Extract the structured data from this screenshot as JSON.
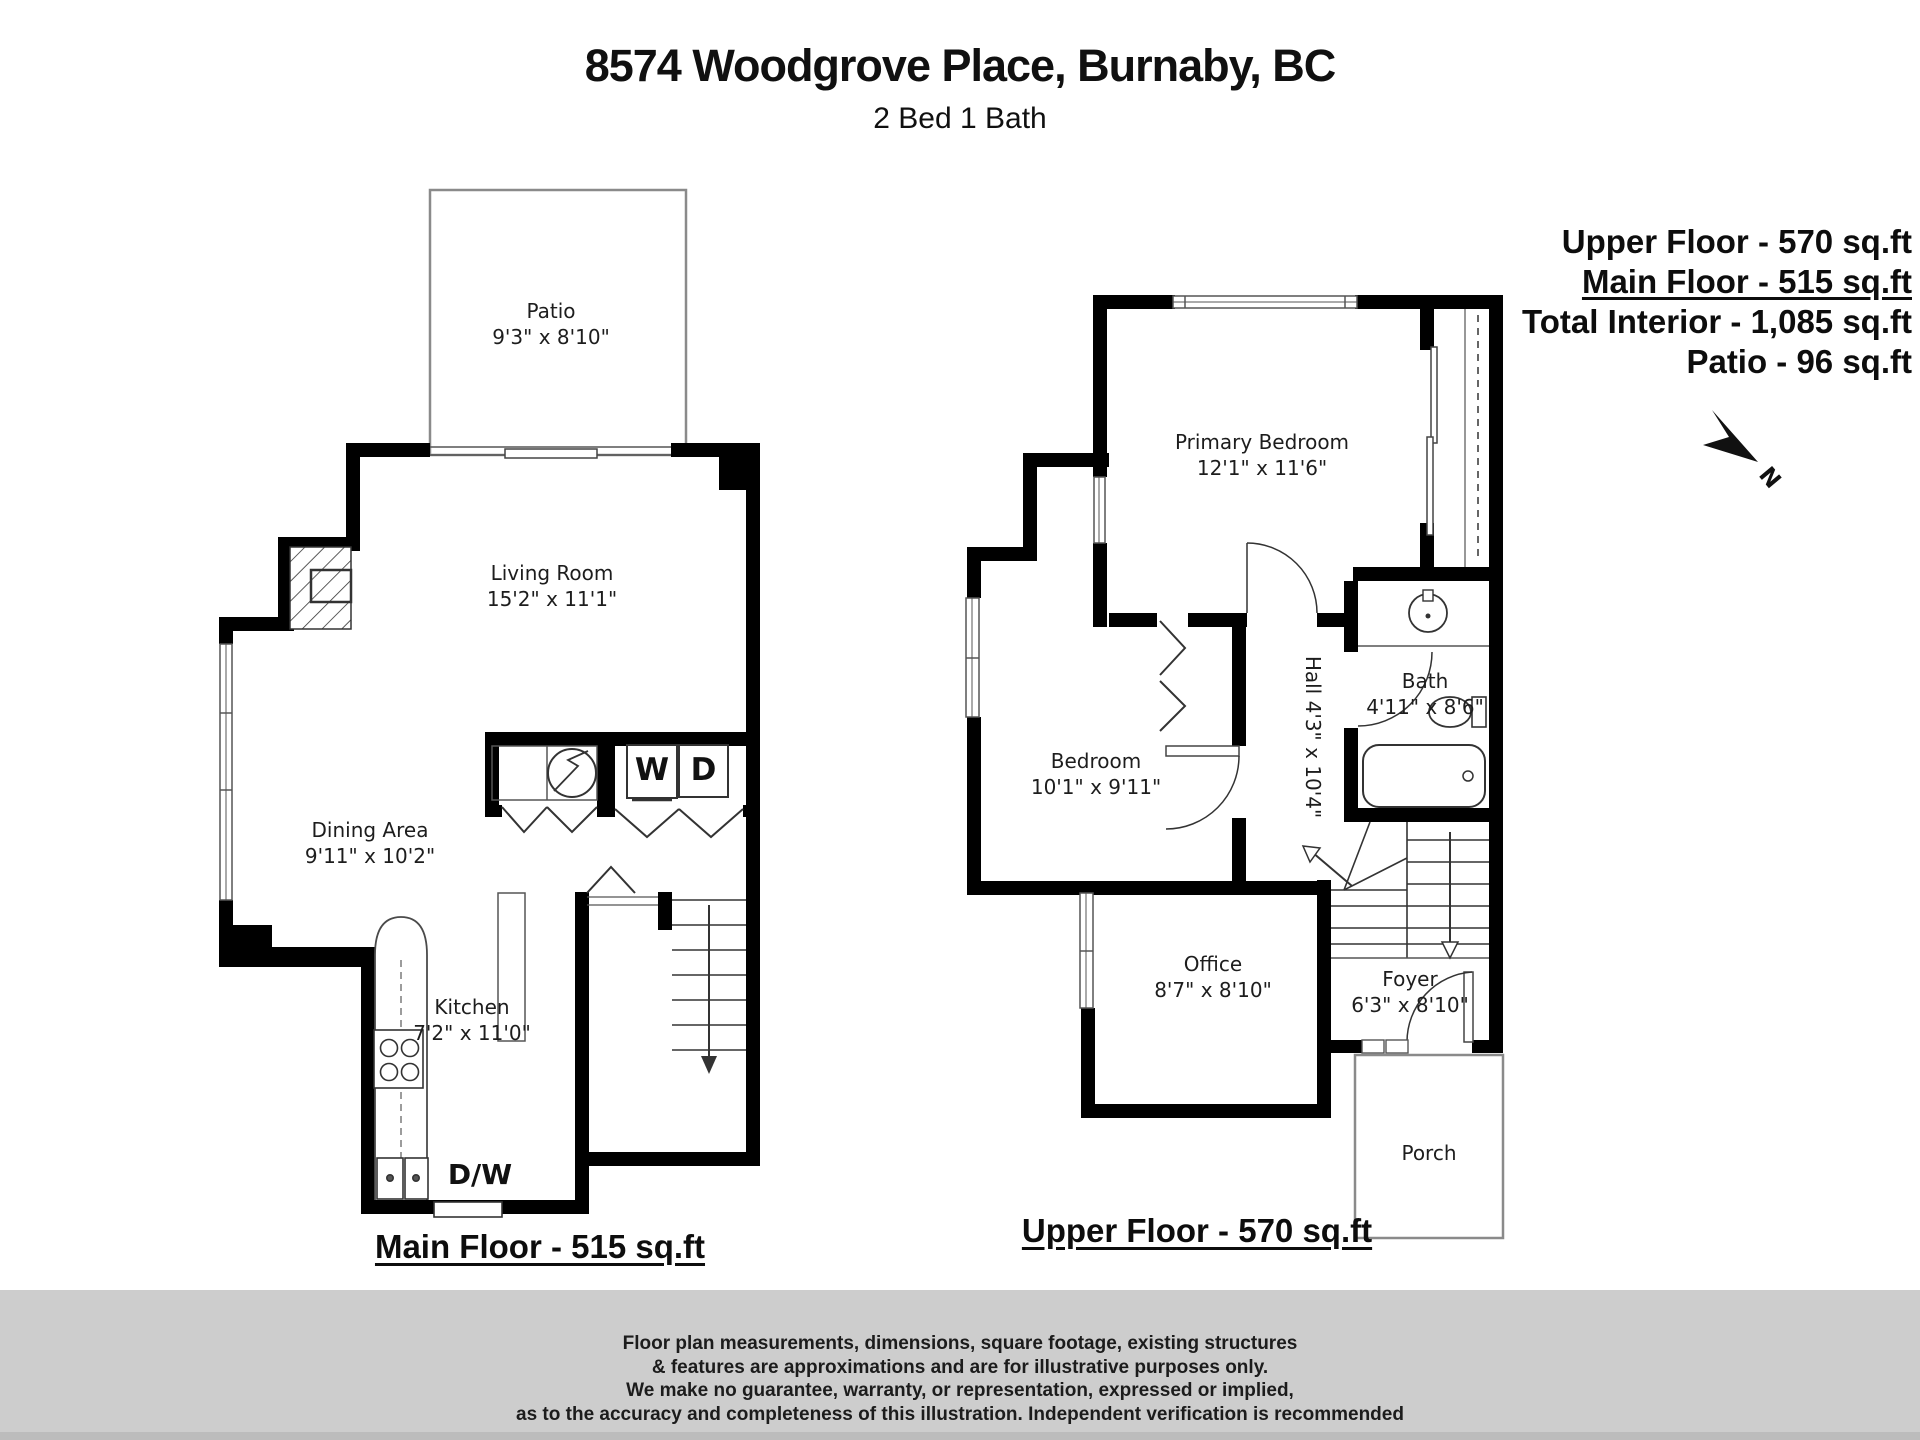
{
  "page": {
    "background": "#ffffff",
    "wall_color": "#000000",
    "footer_bg": "#cdcdcd"
  },
  "header": {
    "title": "8574 Woodgrove Place, Burnaby, BC",
    "subtitle": "2 Bed 1 Bath"
  },
  "stats": {
    "upper": "Upper Floor - 570 sq.ft",
    "main": "Main Floor - 515 sq.ft",
    "total": "Total Interior - 1,085 sq.ft",
    "patio": "Patio - 96 sq.ft"
  },
  "compass": {
    "label": "N"
  },
  "main_floor": {
    "caption": "Main Floor - 515 sq.ft",
    "rooms": [
      {
        "name": "Patio",
        "dims": "9'3\" x 8'10\""
      },
      {
        "name": "Living Room",
        "dims": "15'2\" x 11'1\""
      },
      {
        "name": "Dining Area",
        "dims": "9'11\" x 10'2\""
      },
      {
        "name": "Kitchen",
        "dims": "7'2\" x 11'0\""
      }
    ],
    "fixtures": {
      "washer": "W",
      "dryer": "D",
      "dishwasher": "D/W"
    }
  },
  "upper_floor": {
    "caption": "Upper Floor - 570 sq.ft",
    "rooms": [
      {
        "name": "Primary Bedroom",
        "dims": "12'1\" x 11'6\""
      },
      {
        "name": "Bedroom",
        "dims": "10'1\" x 9'11\""
      },
      {
        "name": "Hall",
        "dims": "4'3\" x 10'4\""
      },
      {
        "name": "Bath",
        "dims": "4'11\" x 8'6\""
      },
      {
        "name": "Office",
        "dims": "8'7\" x 8'10\""
      },
      {
        "name": "Foyer",
        "dims": "6'3\" x 8'10\""
      },
      {
        "name": "Porch",
        "dims": ""
      }
    ]
  },
  "disclaimer": {
    "line1": "Floor plan measurements, dimensions, square footage, existing structures",
    "line2": "& features are approximations and are for illustrative purposes only.",
    "line3": "We make no guarantee, warranty, or representation, expressed or implied,",
    "line4": "as to the accuracy and completeness of this illustration. Independent verification is recommended"
  }
}
